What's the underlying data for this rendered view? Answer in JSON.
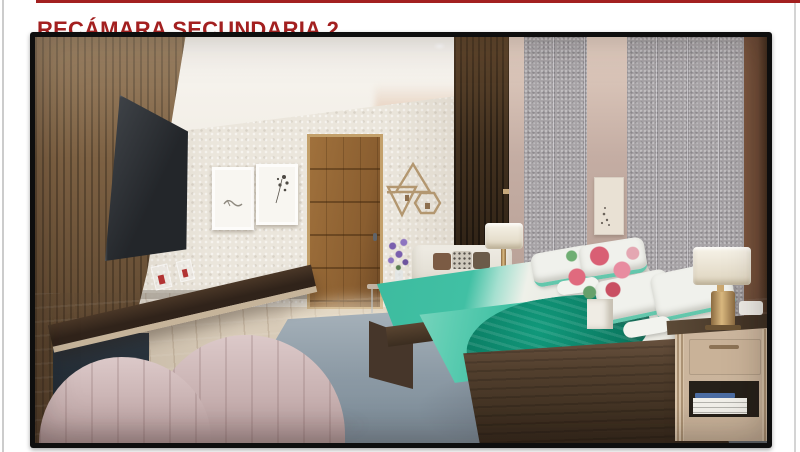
{
  "page": {
    "title": "RECÁMARA SECUNDARIA 2",
    "title_color": "#A32020",
    "rule_color": "#A32020",
    "background": "#ffffff"
  },
  "render": {
    "kind": "3d-interior-rendering",
    "room": "secondary bedroom with two twin beds",
    "frame_color": "#0e0e0e",
    "palette": {
      "title_red": "#A32020",
      "wood_slat_wall": "#7d6143",
      "dark_slat_panel": "#43311f",
      "white_wall": "#ebe6dc",
      "ceiling": "#f6f3ed",
      "door_wood": "#a0713c",
      "gray_panel": "#a7a3a6",
      "mauve_wall": "#c4ada3",
      "right_wood_edge": "#6e4b36",
      "floor_light": "#dbc9b0",
      "floor_dark": "#b69f82",
      "rug_blue_gray": "#8e9ca7",
      "teal_bedding": "#41c0a4",
      "mint_bedding": "#7fd6bf",
      "dark_teal_throw": "#0c8a6e",
      "bed_wood": "#53402e",
      "white_bedding": "#eff0ea",
      "pink_chair": "#c3abab",
      "nightstand_beige": "#c8b299",
      "lamp_gold": "#d9b87f",
      "tv_screen": "#23262a",
      "flower_pink": "#e06a7e",
      "flower_lavender": "#7a5fae"
    },
    "objects": [
      "wood-slat-accent-wall",
      "wall-mounted-tv",
      "floating-media-console",
      "console-decor-boxes",
      "textured-white-wall",
      "framed-art-pair",
      "wooden-door",
      "geometric-wood-wall-decor",
      "dark-wood-slat-panel",
      "upholstered-gray-wall-panels",
      "mauve-wall-strips",
      "botanical-mini-print",
      "twin-bed-near",
      "twin-bed-far",
      "teal-bedding",
      "white-pillows-teal-trim",
      "dark-teal-throw",
      "bedside-table-with-flowers",
      "pink-flower-bouquet",
      "white-cube-vase",
      "glass-side-table",
      "lavender-vase",
      "white-bench-sofa",
      "table-lamp-small",
      "table-lamp-large",
      "nightstand-with-books",
      "blue-gray-area-rug",
      "wood-plank-floor",
      "pink-channel-tufted-armchair",
      "ceiling-recessed-light"
    ]
  }
}
